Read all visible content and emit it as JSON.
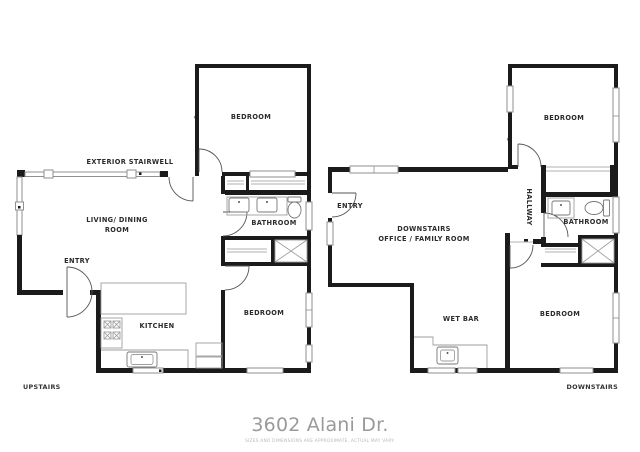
{
  "title": {
    "text": "3602 Alani Dr.",
    "color": "#9a9a9a"
  },
  "disclaimer": {
    "text": "SIZES AND DIMENSIONS ARE APPROXIMATE, ACTUAL MAY VARY."
  },
  "colors": {
    "wall": "#1b1b1b",
    "window_stroke": "#8f8f8f",
    "door_arc": "#555555",
    "fixture_stroke": "#777777",
    "label": "#2b2b2b",
    "title": "#9a9a9a",
    "disclaimer": "#b9b9b9",
    "background": "#ffffff"
  },
  "plans": {
    "upstairs": {
      "floor_label": "UPSTAIRS",
      "rooms": {
        "bedroom_top": "BEDROOM",
        "exterior_stairwell": "EXTERIOR STAIRWELL",
        "living_dining_line1": "LIVING/ DINING",
        "living_dining_line2": "ROOM",
        "entry": "ENTRY",
        "bathroom": "BATHROOM",
        "kitchen": "KITCHEN",
        "bedroom_bottom": "BEDROOM"
      }
    },
    "downstairs": {
      "floor_label": "DOWNSTAIRS",
      "rooms": {
        "bedroom_top": "BEDROOM",
        "entry": "ENTRY",
        "office_line1": "DOWNSTAIRS",
        "office_line2": "OFFICE / FAMILY ROOM",
        "hallway": "HALLWAY",
        "bathroom": "BATHROOM",
        "wet_bar": "WET BAR",
        "bedroom_bottom": "BEDROOM"
      }
    }
  }
}
